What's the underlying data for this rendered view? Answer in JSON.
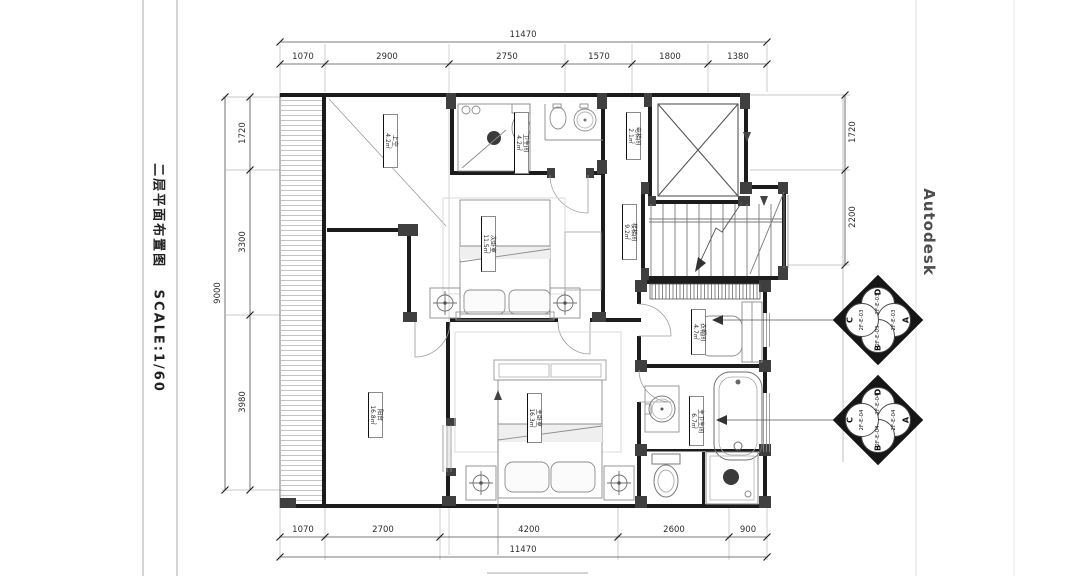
{
  "title_block": {
    "name": "二层平面布置图",
    "scale": "SCALE:1/60"
  },
  "watermark": {
    "brand": "Autodesk"
  },
  "colors": {
    "wall": "#1c1c1c",
    "column": "#3f3f3f",
    "dimension": "#5a5a5a",
    "furniture": "#8c8c8c",
    "background": "#ffffff"
  },
  "dimensions": {
    "top": {
      "total": "11470",
      "segments": [
        "1070",
        "2900",
        "2750",
        "1570",
        "1800",
        "1380"
      ]
    },
    "bottom": {
      "total": "11470",
      "segments": [
        "1070",
        "2700",
        "4200",
        "2600",
        "900"
      ]
    },
    "left": {
      "total": "9000",
      "segments": [
        "1720",
        "3300",
        "3980"
      ]
    },
    "right": {
      "segments": [
        "1720",
        "2200"
      ]
    }
  },
  "rooms": [
    {
      "name": "上空",
      "area": "4.2㎡"
    },
    {
      "name": "卫生间",
      "area": "4.2㎡"
    },
    {
      "name": "电梯间",
      "area": "2.1㎡"
    },
    {
      "name": "楼梯间",
      "area": "9.2㎡"
    },
    {
      "name": "次卧室",
      "area": "11.5㎡"
    },
    {
      "name": "衣帽间",
      "area": "4.7㎡"
    },
    {
      "name": "主卧室",
      "area": "16.3㎡"
    },
    {
      "name": "阳台",
      "area": "16.8㎡"
    },
    {
      "name": "主卫生间",
      "area": "6.7㎡"
    }
  ],
  "elevation_markers": [
    {
      "id": "2F-E-03",
      "quadrants": [
        "A",
        "B",
        "C",
        "D"
      ]
    },
    {
      "id": "2F-E-04",
      "quadrants": [
        "A",
        "B",
        "C",
        "D"
      ]
    }
  ]
}
